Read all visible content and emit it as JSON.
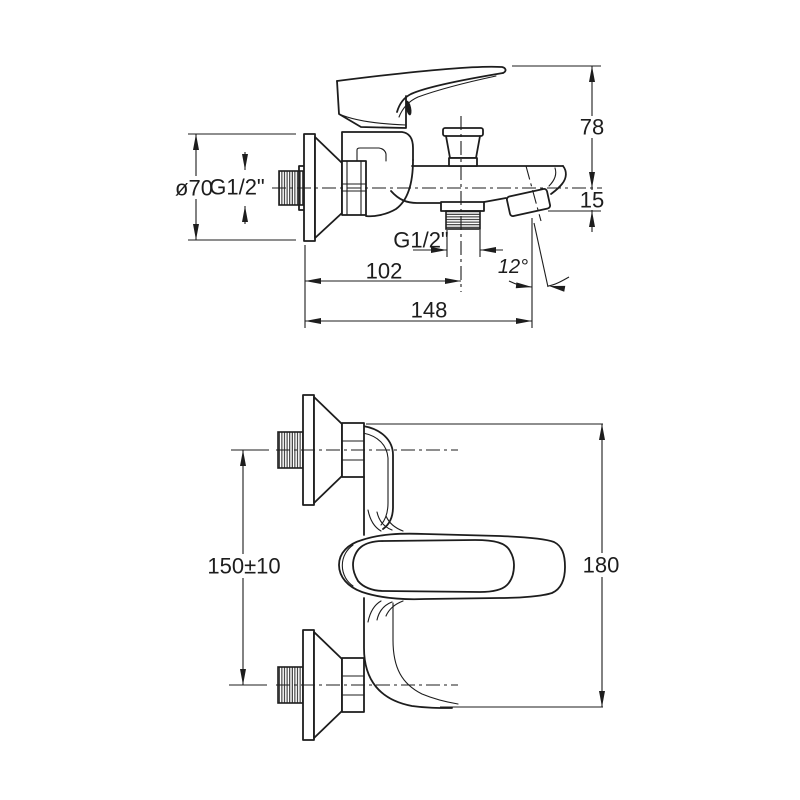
{
  "side_view": {
    "flange_diameter": "ø70",
    "inlet_thread": "G1/2\"",
    "height_above_axis": "78",
    "spout_drop": "15",
    "shower_outlet_thread": "G1/2\"",
    "wall_to_outlet_center": "102",
    "overall_projection": "148",
    "spout_angle": "12°"
  },
  "plan_view": {
    "connection_centers_distance": "150±10",
    "overall_height": "180"
  },
  "colors": {
    "line": "#1d1d1d",
    "background": "#ffffff"
  }
}
